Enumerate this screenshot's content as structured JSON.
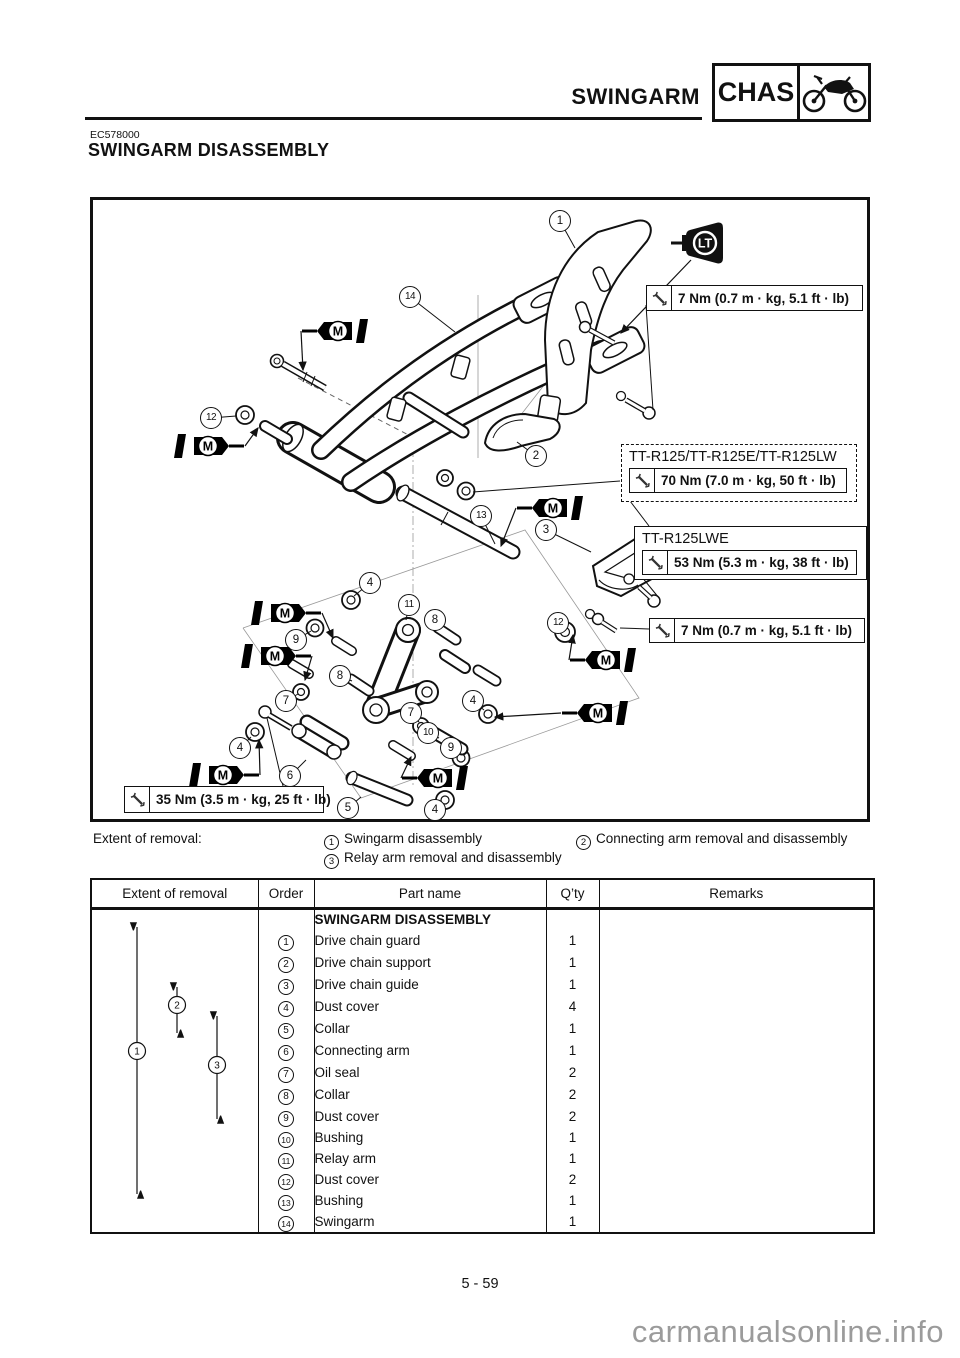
{
  "header": {
    "section_title": "SWINGARM",
    "chapter_code": "CHAS"
  },
  "doc_code": "EC578000",
  "title": "SWINGARM DISASSEMBLY",
  "page_number": "5 - 59",
  "watermark": "carmanualsonline.info",
  "diagram": {
    "labels": {
      "loctite": "LT",
      "grease": "M"
    },
    "torque_specs": [
      {
        "text": "7 Nm (0.7 m · kg, 5.1 ft · lb)"
      },
      {
        "model": "TT-R125/TT-R125E/TT-R125LW",
        "text": "70 Nm (7.0 m · kg, 50 ft · lb)"
      },
      {
        "model": "TT-R125LWE",
        "text": "53 Nm (5.3 m · kg, 38 ft · lb)"
      },
      {
        "text": "7 Nm (0.7 m · kg, 5.1 ft · lb)"
      },
      {
        "text": "35 Nm (3.5 m · kg, 25 ft · lb)"
      }
    ],
    "callouts": [
      {
        "n": "1",
        "x": 467,
        "y": 21,
        "tx": 482,
        "ty": 48
      },
      {
        "n": "14",
        "x": 317,
        "y": 97,
        "tx": 362,
        "ty": 132
      },
      {
        "n": "2",
        "x": 443,
        "y": 256,
        "tx": 424,
        "ty": 242
      },
      {
        "n": "12",
        "x": 118,
        "y": 218,
        "tx": 143,
        "ty": 216
      },
      {
        "n": "13",
        "x": 388,
        "y": 316,
        "tx": 402,
        "ty": 344
      },
      {
        "n": "3",
        "x": 453,
        "y": 330,
        "tx": 498,
        "ty": 352
      },
      {
        "n": "12",
        "x": 465,
        "y": 423,
        "tx": 470,
        "ty": 430
      },
      {
        "n": "4",
        "x": 277,
        "y": 383,
        "tx": 261,
        "ty": 396
      },
      {
        "n": "11",
        "x": 316,
        "y": 405,
        "tx": 313,
        "ty": 420
      },
      {
        "n": "8",
        "x": 342,
        "y": 420,
        "tx": 349,
        "ty": 427
      },
      {
        "n": "9",
        "x": 203,
        "y": 440,
        "tx": 218,
        "ty": 431
      },
      {
        "n": "8",
        "x": 247,
        "y": 476,
        "tx": 259,
        "ty": 481
      },
      {
        "n": "7",
        "x": 193,
        "y": 501,
        "tx": 205,
        "ty": 494
      },
      {
        "n": "7",
        "x": 318,
        "y": 513,
        "tx": 326,
        "ty": 522
      },
      {
        "n": "4",
        "x": 380,
        "y": 501,
        "tx": 391,
        "ty": 510
      },
      {
        "n": "10",
        "x": 335,
        "y": 533,
        "tx": 346,
        "ty": 538
      },
      {
        "n": "9",
        "x": 358,
        "y": 548,
        "tx": 365,
        "ty": 555
      },
      {
        "n": "4",
        "x": 147,
        "y": 548,
        "tx": 158,
        "ty": 537
      },
      {
        "n": "6",
        "x": 197,
        "y": 576,
        "tx": 213,
        "ty": 560
      },
      {
        "n": "5",
        "x": 255,
        "y": 608,
        "tx": 268,
        "ty": 597
      },
      {
        "n": "4",
        "x": 342,
        "y": 610,
        "tx": 349,
        "ty": 603
      }
    ],
    "grease_icons": [
      {
        "x": 247,
        "y": 131,
        "dir": "left",
        "tx": 210,
        "ty": 170
      },
      {
        "x": 113,
        "y": 246,
        "dir": "right",
        "tx": 165,
        "ty": 228
      },
      {
        "x": 462,
        "y": 308,
        "dir": "left",
        "tx": 408,
        "ty": 346
      },
      {
        "x": 515,
        "y": 460,
        "dir": "left",
        "tx": 480,
        "ty": 435
      },
      {
        "x": 190,
        "y": 413,
        "dir": "right",
        "tx": 240,
        "ty": 438
      },
      {
        "x": 180,
        "y": 456,
        "dir": "right",
        "tx": 212,
        "ty": 480
      },
      {
        "x": 128,
        "y": 575,
        "dir": "right",
        "tx": 166,
        "ty": 540
      },
      {
        "x": 347,
        "y": 578,
        "dir": "left",
        "tx": 318,
        "ty": 557
      },
      {
        "x": 507,
        "y": 513,
        "dir": "left",
        "tx": 402,
        "ty": 517
      }
    ]
  },
  "extent_of_removal": {
    "label": "Extent of removal:",
    "items": [
      {
        "n": "1",
        "text": "Swingarm disassembly"
      },
      {
        "n": "2",
        "text": "Connecting arm removal and disassembly"
      },
      {
        "n": "3",
        "text": "Relay arm removal and disassembly"
      }
    ]
  },
  "table": {
    "headers": [
      "Extent of removal",
      "Order",
      "Part name",
      "Q’ty",
      "Remarks"
    ],
    "rows": [
      {
        "section": true,
        "order": "",
        "part": "SWINGARM DISASSEMBLY",
        "qty": "",
        "remarks": ""
      },
      {
        "order": "1",
        "part": "Drive chain guard",
        "qty": "1",
        "remarks": ""
      },
      {
        "order": "2",
        "part": "Drive chain support",
        "qty": "1",
        "remarks": ""
      },
      {
        "order": "3",
        "part": "Drive chain guide",
        "qty": "1",
        "remarks": ""
      },
      {
        "order": "4",
        "part": "Dust cover",
        "qty": "4",
        "remarks": ""
      },
      {
        "order": "5",
        "part": "Collar",
        "qty": "1",
        "remarks": ""
      },
      {
        "order": "6",
        "part": "Connecting arm",
        "qty": "1",
        "remarks": ""
      },
      {
        "order": "7",
        "part": "Oil seal",
        "qty": "2",
        "remarks": ""
      },
      {
        "order": "8",
        "part": "Collar",
        "qty": "2",
        "remarks": ""
      },
      {
        "order": "9",
        "part": "Dust cover",
        "qty": "2",
        "remarks": ""
      },
      {
        "order": "10",
        "part": "Bushing",
        "qty": "1",
        "remarks": ""
      },
      {
        "order": "11",
        "part": "Relay arm",
        "qty": "1",
        "remarks": ""
      },
      {
        "order": "12",
        "part": "Dust cover",
        "qty": "2",
        "remarks": ""
      },
      {
        "order": "13",
        "part": "Bushing",
        "qty": "1",
        "remarks": ""
      },
      {
        "order": "14",
        "part": "Swingarm",
        "qty": "1",
        "remarks": ""
      }
    ],
    "extent_arrows": [
      {
        "n": "1",
        "x": 44,
        "y1": 18,
        "y2": 285,
        "cy": 142
      },
      {
        "n": "2",
        "x": 84,
        "y1": 78,
        "y2": 124,
        "cy": 96
      },
      {
        "n": "3",
        "x": 124,
        "y1": 107,
        "y2": 210,
        "cy": 156
      }
    ]
  }
}
